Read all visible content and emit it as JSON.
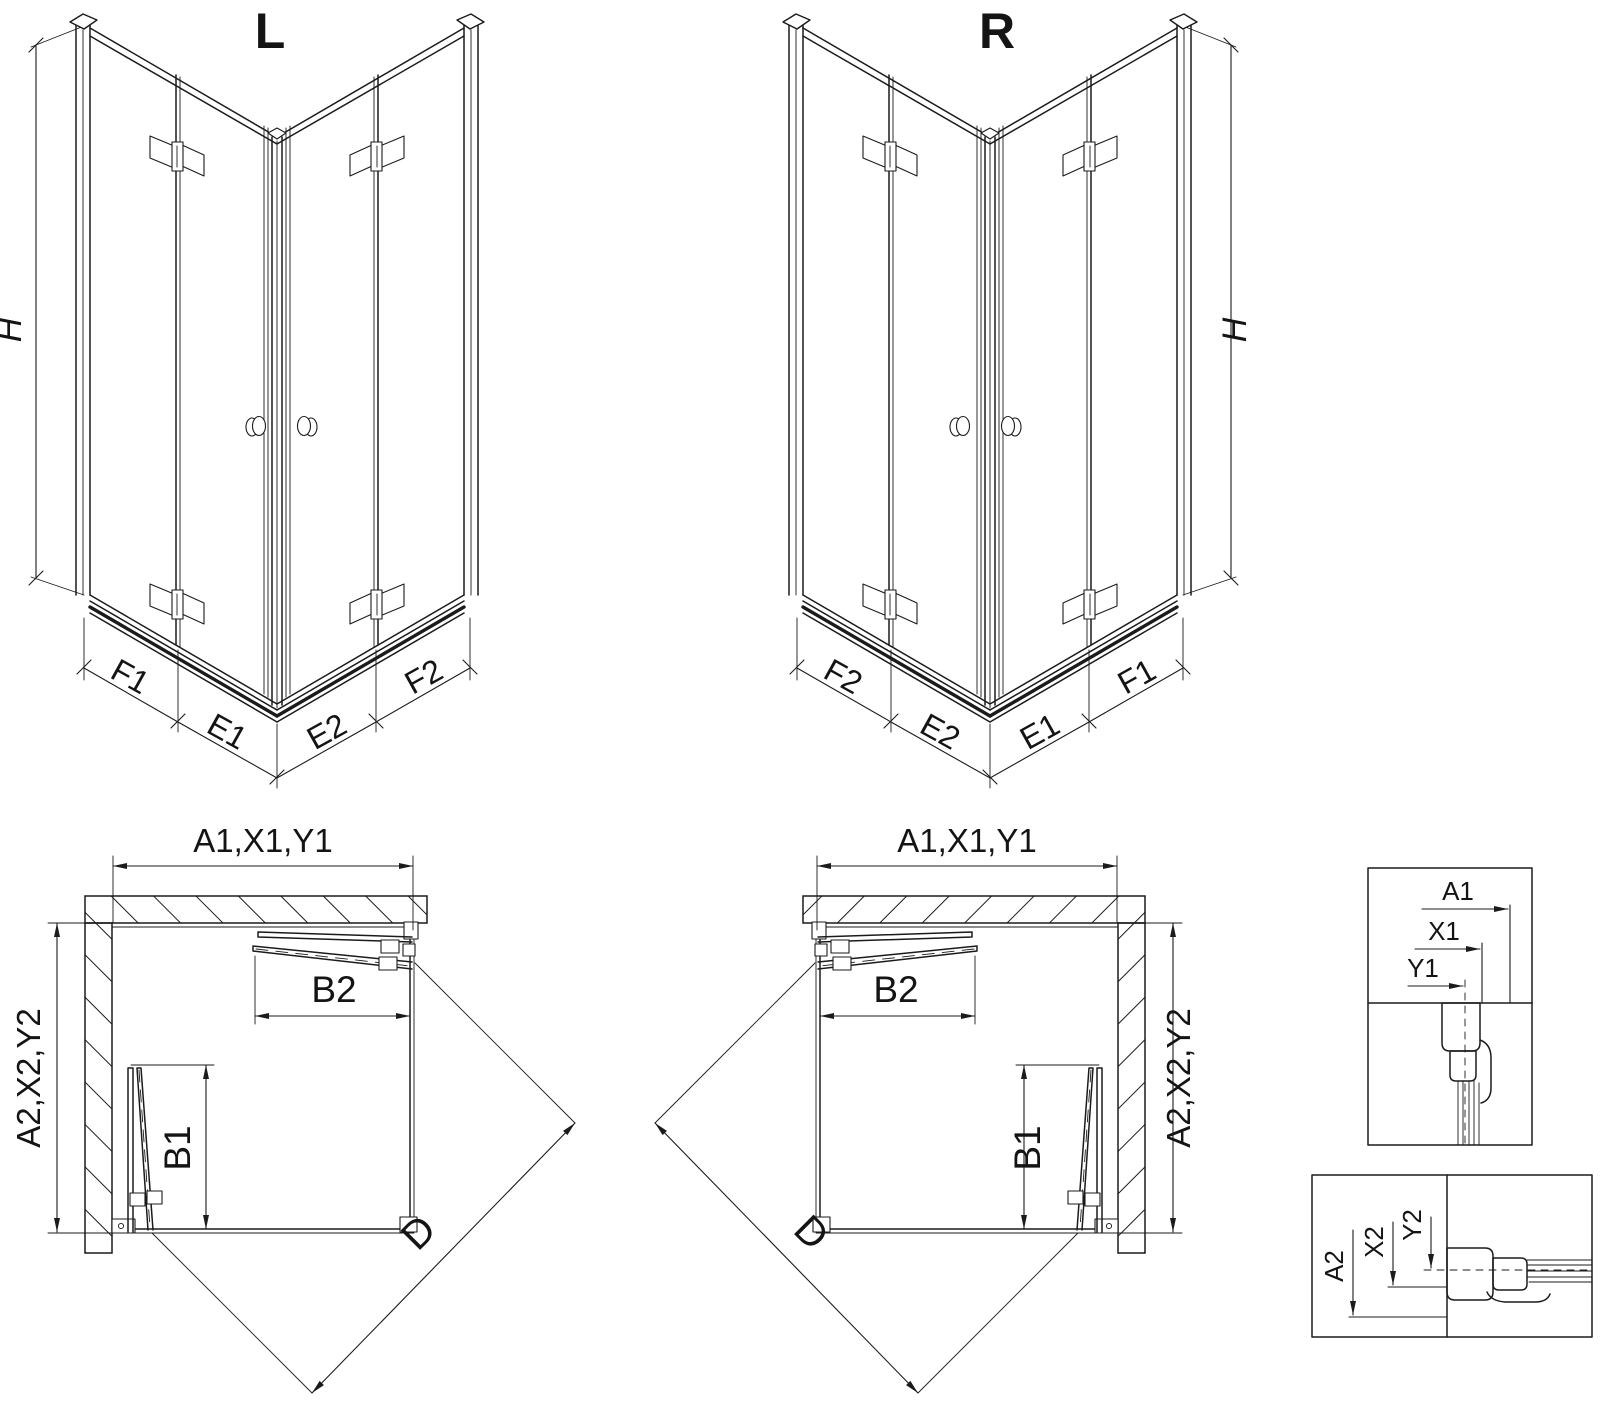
{
  "drawing": {
    "colors": {
      "line": "#1b1b1b",
      "background": "#ffffff"
    },
    "views": {
      "iso_left": {
        "title": "L",
        "height_label": "H",
        "segments": {
          "f1": "F1",
          "e1": "E1",
          "e2": "E2",
          "f2": "F2"
        }
      },
      "iso_right": {
        "title": "R",
        "height_label": "H",
        "segments": {
          "f2": "F2",
          "e2": "E2",
          "e1": "E1",
          "f1": "F1"
        }
      },
      "plan_left": {
        "width_label": "A1,X1,Y1",
        "depth_label": "A2,X2,Y2",
        "door_b2_label": "B2",
        "door_b1_label": "B1",
        "diagonal_label": "D"
      },
      "plan_right": {
        "width_label": "A1,X1,Y1",
        "depth_label": "A2,X2,Y2",
        "door_b2_label": "B2",
        "door_b1_label": "B1",
        "diagonal_label": "D"
      },
      "detail_top": {
        "a": "A1",
        "x": "X1",
        "y": "Y1"
      },
      "detail_bottom": {
        "a": "A2",
        "x": "X2",
        "y": "Y2"
      }
    }
  }
}
